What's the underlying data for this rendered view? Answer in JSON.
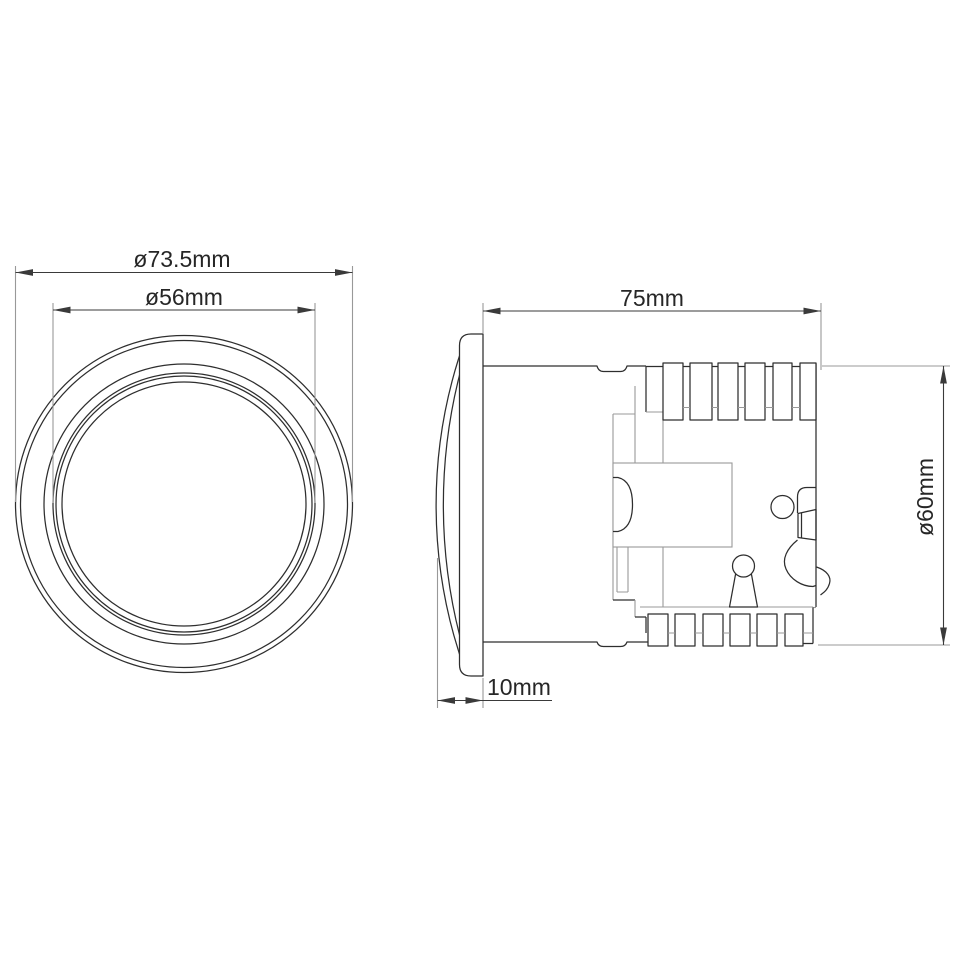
{
  "colors": {
    "line": "#2e2e2e",
    "light": "#999999",
    "dim": "#3a3a3a",
    "text": "#262626",
    "bg": "#ffffff"
  },
  "front_view": {
    "outer_diameter_label": "ø73.5mm",
    "bezel_inner_diameter_label": "ø56mm"
  },
  "side_view": {
    "overall_length_label": "75mm",
    "body_diameter_label": "ø60mm",
    "lens_depth_label": "10mm"
  }
}
